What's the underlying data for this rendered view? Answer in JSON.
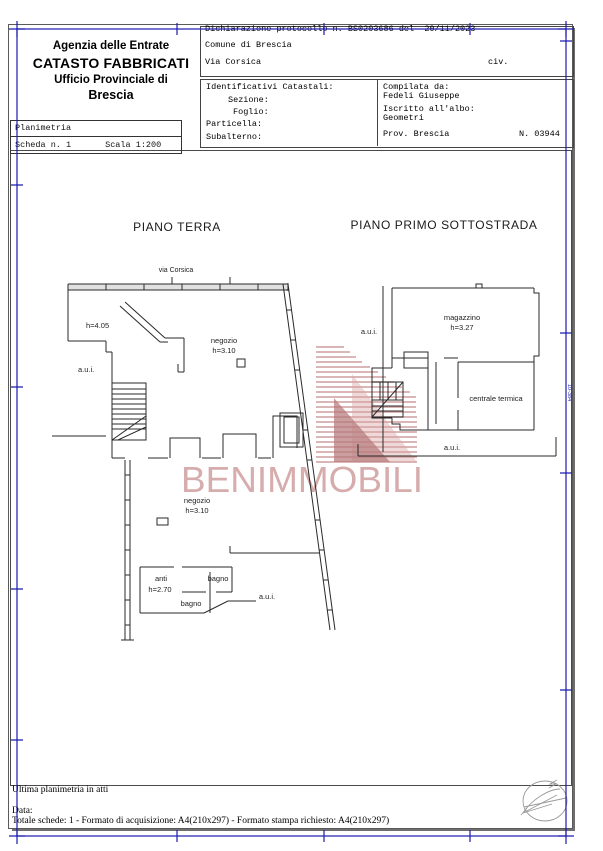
{
  "header": {
    "agency": {
      "line1": "Agenzia delle Entrate",
      "line2": "CATASTO FABBRICATI",
      "line3": "Ufficio Provinciale di",
      "line4": "Brescia"
    },
    "declaration": "Dichiarazione protocollo n. BS0203686 del  20/11/2023",
    "comune": "Comune di Brescia",
    "street": "Via Corsica",
    "civ_label": "civ.",
    "cadastral": {
      "title": "Identificativi Catastali:",
      "sezione": "Sezione:",
      "foglio": "Foglio:",
      "particella": "Particella:",
      "subalterno": "Subalterno:"
    },
    "compiler": {
      "label": "Compilata da:",
      "name": "Fedeli Giuseppe",
      "albo_label": "Iscritto all'albo:",
      "albo": "Geometri",
      "prov": "Prov. Brescia",
      "number": "N. 03944"
    }
  },
  "planimetria_box": {
    "title": "Planimetria",
    "sheet": "Scheda n. 1",
    "scale": "Scala 1:200"
  },
  "plans": {
    "ground": {
      "title": "PIANO TERRA",
      "street": "via Corsica",
      "labels": {
        "h405": "h=4.05",
        "aui_left": "a.u.i.",
        "negozio1": "negozio",
        "h310a": "h=3.10",
        "negozio2": "negozio",
        "h310b": "h=3.10",
        "anti": "anti",
        "h270": "h=2.70",
        "bagno1": "bagno",
        "bagno2": "bagno",
        "aui_bottom": "a.u.i."
      }
    },
    "basement": {
      "title": "PIANO PRIMO SOTTOSTRADA",
      "labels": {
        "aui_left": "a.u.i.",
        "magazzino": "magazzino",
        "h327": "h=3.27",
        "centrale": "centrale termica",
        "aui_bottom": "a.u.i."
      }
    }
  },
  "watermark": {
    "text": "BENIMMOBILI",
    "text_color": "#d2a4a4",
    "stripe_color": "#b46868"
  },
  "footer": {
    "line1": "Ultima planimetria in atti",
    "line2": "Data:",
    "line3": "Totale schede: 1 - Formato di acquisizione: A4(210x297)  - Formato stampa richiesto: A4(210x297)"
  },
  "edge_code": "10-384",
  "colors": {
    "frame_blue": "#1c1cb0",
    "border_gray": "#5a5a5a",
    "line_black": "#2a2a2a"
  }
}
